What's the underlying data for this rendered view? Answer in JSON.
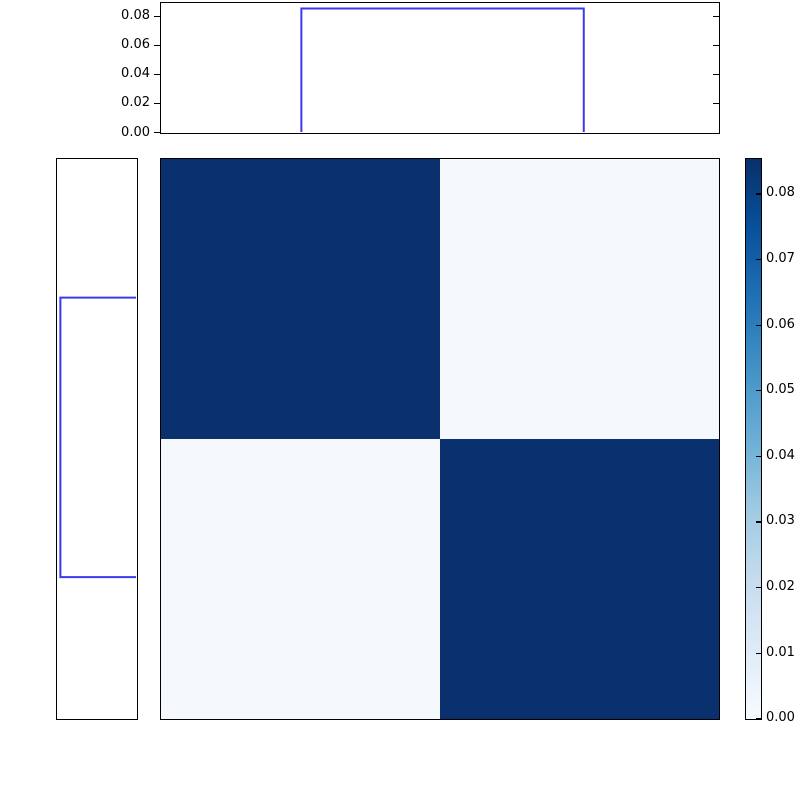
{
  "chart_data": {
    "type": "heatmap",
    "title": "",
    "xlabel": "",
    "ylabel": "",
    "grid": false,
    "heatmap": {
      "rows": 2,
      "cols": 2,
      "matrix": [
        [
          0.085,
          0.002
        ],
        [
          0.002,
          0.085
        ]
      ],
      "vmin": 0.0,
      "vmax": 0.0852,
      "colormap": "Blues",
      "diagonal_color": "#0a316d",
      "off_diagonal_color": "#f5f9fe",
      "frame_color": "#000000"
    },
    "top_marginal": {
      "type": "step",
      "line_color": "#3a3aec",
      "axis_max": 0.0888,
      "y_tick_labels": [
        "0.00",
        "0.02",
        "0.04",
        "0.06",
        "0.08"
      ],
      "y_tick_values": [
        0.0,
        0.02,
        0.04,
        0.06,
        0.08
      ],
      "step": {
        "start_frac": 0.252,
        "end_frac": 0.759,
        "value": 0.085
      }
    },
    "left_marginal": {
      "type": "step",
      "line_color": "#3a3aec",
      "axis_max": 0.0888,
      "inverted_axis": true,
      "step": {
        "start_frac": 0.248,
        "end_frac": 0.748,
        "value": 0.085
      }
    },
    "colorbar": {
      "tick_labels": [
        "0.00",
        "0.01",
        "0.02",
        "0.03",
        "0.04",
        "0.05",
        "0.06",
        "0.07",
        "0.08"
      ],
      "tick_values": [
        0.0,
        0.01,
        0.02,
        0.03,
        0.04,
        0.05,
        0.06,
        0.07,
        0.08
      ],
      "vmin": 0.0,
      "vmax": 0.0852,
      "gradient_stops": [
        {
          "pos": 0.0,
          "color": "#f7fbff"
        },
        {
          "pos": 0.125,
          "color": "#deebf7"
        },
        {
          "pos": 0.25,
          "color": "#c6dbef"
        },
        {
          "pos": 0.375,
          "color": "#9ecae1"
        },
        {
          "pos": 0.5,
          "color": "#6baed6"
        },
        {
          "pos": 0.625,
          "color": "#4292c6"
        },
        {
          "pos": 0.75,
          "color": "#2171b5"
        },
        {
          "pos": 0.875,
          "color": "#08519c"
        },
        {
          "pos": 1.0,
          "color": "#08306b"
        }
      ]
    },
    "background_color": "#ffffff"
  }
}
